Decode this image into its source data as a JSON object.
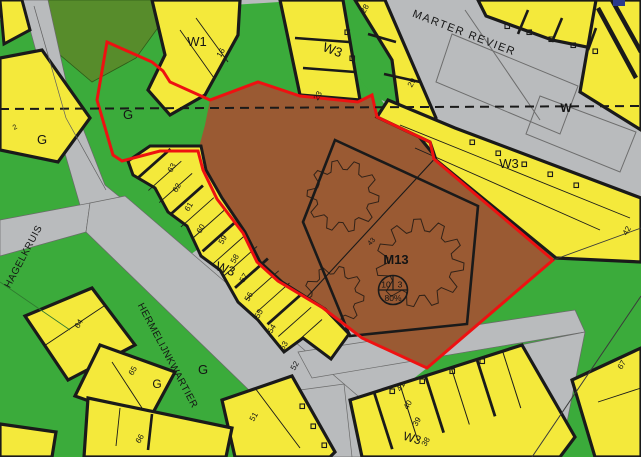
{
  "map": {
    "colors": {
      "yellow": "#F4E93B",
      "green": "#3BAB3B",
      "dark_green": "#578C2B",
      "road_gray": "#B9BBBD",
      "brown": "#9A5A33",
      "boundary_red": "#EE1111",
      "ink": "#1A1A1A",
      "thin_line": "#555555",
      "blue_artifact": "#2A3A8C"
    },
    "zone_m13": {
      "label": "M13",
      "circle_top_left": "10",
      "circle_top_right": "3",
      "circle_bottom": "80%"
    },
    "labels": [
      {
        "text": "MARTER REVIER",
        "x": 463,
        "y": 36,
        "rot": 21,
        "size": 11,
        "ls": 1.5,
        "kind": "street"
      },
      {
        "text": "HAGELKRUIS",
        "x": 26,
        "y": 258,
        "rot": -62,
        "size": 10,
        "ls": 0.5,
        "kind": "street"
      },
      {
        "text": "HERMELIJNKWARTIER",
        "x": 165,
        "y": 357,
        "rot": 62,
        "size": 10,
        "ls": 0.5,
        "kind": "street"
      },
      {
        "text": "W1",
        "x": 197,
        "y": 46,
        "rot": 0,
        "size": 13,
        "kind": "area"
      },
      {
        "text": "W3",
        "x": 331,
        "y": 54,
        "rot": 21,
        "size": 13,
        "kind": "area"
      },
      {
        "text": "W3",
        "x": 509,
        "y": 168,
        "rot": 0,
        "size": 13,
        "kind": "area"
      },
      {
        "text": "W3",
        "x": 224,
        "y": 273,
        "rot": 20,
        "size": 13,
        "kind": "area"
      },
      {
        "text": "W3",
        "x": 411,
        "y": 442,
        "rot": 17,
        "size": 12,
        "kind": "area"
      },
      {
        "text": "G",
        "x": 128,
        "y": 119,
        "rot": 0,
        "size": 13,
        "kind": "area"
      },
      {
        "text": "G",
        "x": 42,
        "y": 144,
        "rot": 0,
        "size": 13,
        "kind": "area"
      },
      {
        "text": "G",
        "x": 203,
        "y": 374,
        "rot": 0,
        "size": 13,
        "kind": "area"
      },
      {
        "text": "G",
        "x": 157,
        "y": 388,
        "rot": 0,
        "size": 12,
        "kind": "area"
      },
      {
        "text": "M13",
        "x": 396,
        "y": 264,
        "rot": 0,
        "size": 13,
        "bold": true,
        "kind": "zone"
      },
      {
        "text": "W",
        "x": 566,
        "y": 112,
        "rot": 0,
        "size": 12,
        "bold": true,
        "kind": "marker"
      },
      {
        "text": "63",
        "x": 174,
        "y": 169,
        "rot": -60,
        "size": 8,
        "kind": "house-number"
      },
      {
        "text": "62",
        "x": 179,
        "y": 189,
        "rot": -60,
        "size": 8,
        "kind": "house-number"
      },
      {
        "text": "61",
        "x": 191,
        "y": 208,
        "rot": -60,
        "size": 8,
        "kind": "house-number"
      },
      {
        "text": "60",
        "x": 203,
        "y": 230,
        "rot": -60,
        "size": 8,
        "kind": "house-number"
      },
      {
        "text": "59",
        "x": 225,
        "y": 241,
        "rot": -60,
        "size": 8,
        "kind": "house-number"
      },
      {
        "text": "58",
        "x": 237,
        "y": 260,
        "rot": -60,
        "size": 8,
        "kind": "house-number"
      },
      {
        "text": "57",
        "x": 246,
        "y": 279,
        "rot": -60,
        "size": 8,
        "kind": "house-number"
      },
      {
        "text": "56",
        "x": 251,
        "y": 298,
        "rot": -60,
        "size": 8,
        "kind": "house-number"
      },
      {
        "text": "55",
        "x": 261,
        "y": 315,
        "rot": -60,
        "size": 8,
        "kind": "house-number"
      },
      {
        "text": "54",
        "x": 274,
        "y": 330,
        "rot": -60,
        "size": 8,
        "kind": "house-number"
      },
      {
        "text": "53",
        "x": 286,
        "y": 347,
        "rot": -60,
        "size": 8,
        "kind": "house-number"
      },
      {
        "text": "52",
        "x": 297,
        "y": 367,
        "rot": -60,
        "size": 8,
        "kind": "house-number"
      },
      {
        "text": "51",
        "x": 256,
        "y": 418,
        "rot": -60,
        "size": 8,
        "kind": "house-number"
      },
      {
        "text": "64",
        "x": 81,
        "y": 325,
        "rot": -60,
        "size": 8,
        "kind": "house-number"
      },
      {
        "text": "65",
        "x": 135,
        "y": 372,
        "rot": -60,
        "size": 8,
        "kind": "house-number"
      },
      {
        "text": "66",
        "x": 142,
        "y": 440,
        "rot": -60,
        "size": 8,
        "kind": "house-number"
      },
      {
        "text": "41",
        "x": 403,
        "y": 388,
        "rot": -60,
        "size": 8,
        "kind": "house-number"
      },
      {
        "text": "40",
        "x": 410,
        "y": 406,
        "rot": -60,
        "size": 8,
        "kind": "house-number"
      },
      {
        "text": "39",
        "x": 419,
        "y": 423,
        "rot": -60,
        "size": 8,
        "kind": "house-number"
      },
      {
        "text": "38",
        "x": 428,
        "y": 443,
        "rot": -60,
        "size": 8,
        "kind": "house-number"
      },
      {
        "text": "16",
        "x": 223,
        "y": 54,
        "rot": -60,
        "size": 8,
        "kind": "house-number"
      },
      {
        "text": "23",
        "x": 320,
        "y": 97,
        "rot": -60,
        "size": 8,
        "kind": "house-number"
      },
      {
        "text": "28",
        "x": 367,
        "y": 10,
        "rot": -60,
        "size": 8,
        "kind": "house-number"
      },
      {
        "text": "29",
        "x": 414,
        "y": 84,
        "rot": -60,
        "size": 8,
        "kind": "house-number"
      },
      {
        "text": "42",
        "x": 629,
        "y": 232,
        "rot": -60,
        "size": 8,
        "kind": "house-number"
      },
      {
        "text": "67",
        "x": 624,
        "y": 366,
        "rot": -60,
        "size": 8,
        "kind": "house-number"
      },
      {
        "text": "2",
        "x": 16,
        "y": 129,
        "rot": -30,
        "size": 7,
        "kind": "house-number"
      },
      {
        "text": "43",
        "x": 373,
        "y": 243,
        "rot": -48,
        "size": 7,
        "kind": "parcel-number"
      }
    ]
  }
}
